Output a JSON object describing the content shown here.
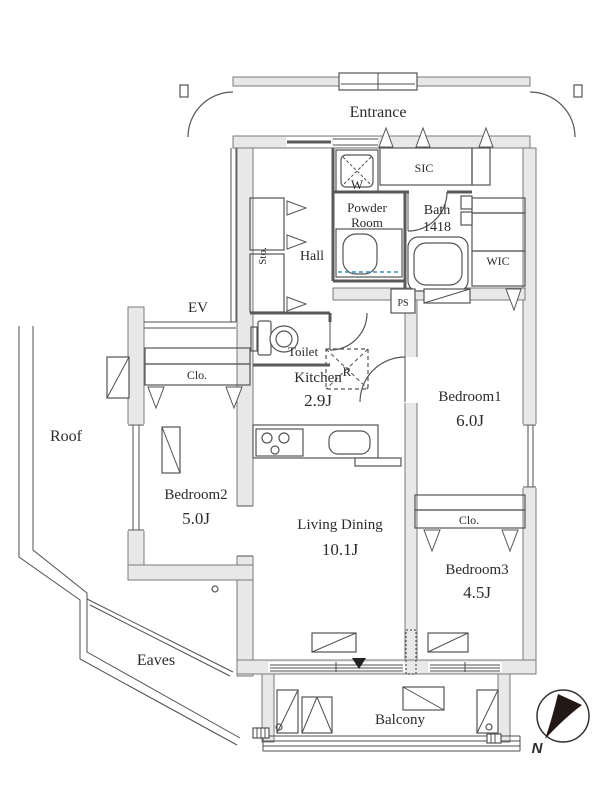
{
  "colors": {
    "closet": "#cfe8f7",
    "closet_light": "#e4f2fb",
    "pan": "#eaf6fd",
    "accent_dash": "#3f8fc0",
    "compass": "#231815"
  },
  "common": {
    "entrance": "Entrance",
    "ev": "EV",
    "roof": "Roof",
    "eaves": "Eaves",
    "balcony": "Balcony"
  },
  "rooms": {
    "hall": "Hall",
    "powder1": "Powder",
    "powder2": "Room",
    "bath": "Bath",
    "bath_size": "1418",
    "toilet": "Toilet",
    "kitchen": "Kitchen",
    "kitchen_area": "2.9J",
    "living": "Living Dining",
    "living_area": "10.1J",
    "bedroom1": "Bedroom1",
    "bedroom1_area": "6.0J",
    "bedroom2": "Bedroom2",
    "bedroom2_area": "5.0J",
    "bedroom3": "Bedroom3",
    "bedroom3_area": "4.5J"
  },
  "storage": {
    "sic": "SIC",
    "wic": "WIC",
    "sto": "Sto.",
    "clo_b2": "Clo.",
    "clo_b13": "Clo.",
    "washer": "W",
    "fridge": "R",
    "ps": "PS"
  },
  "compass": {
    "north": "N"
  }
}
